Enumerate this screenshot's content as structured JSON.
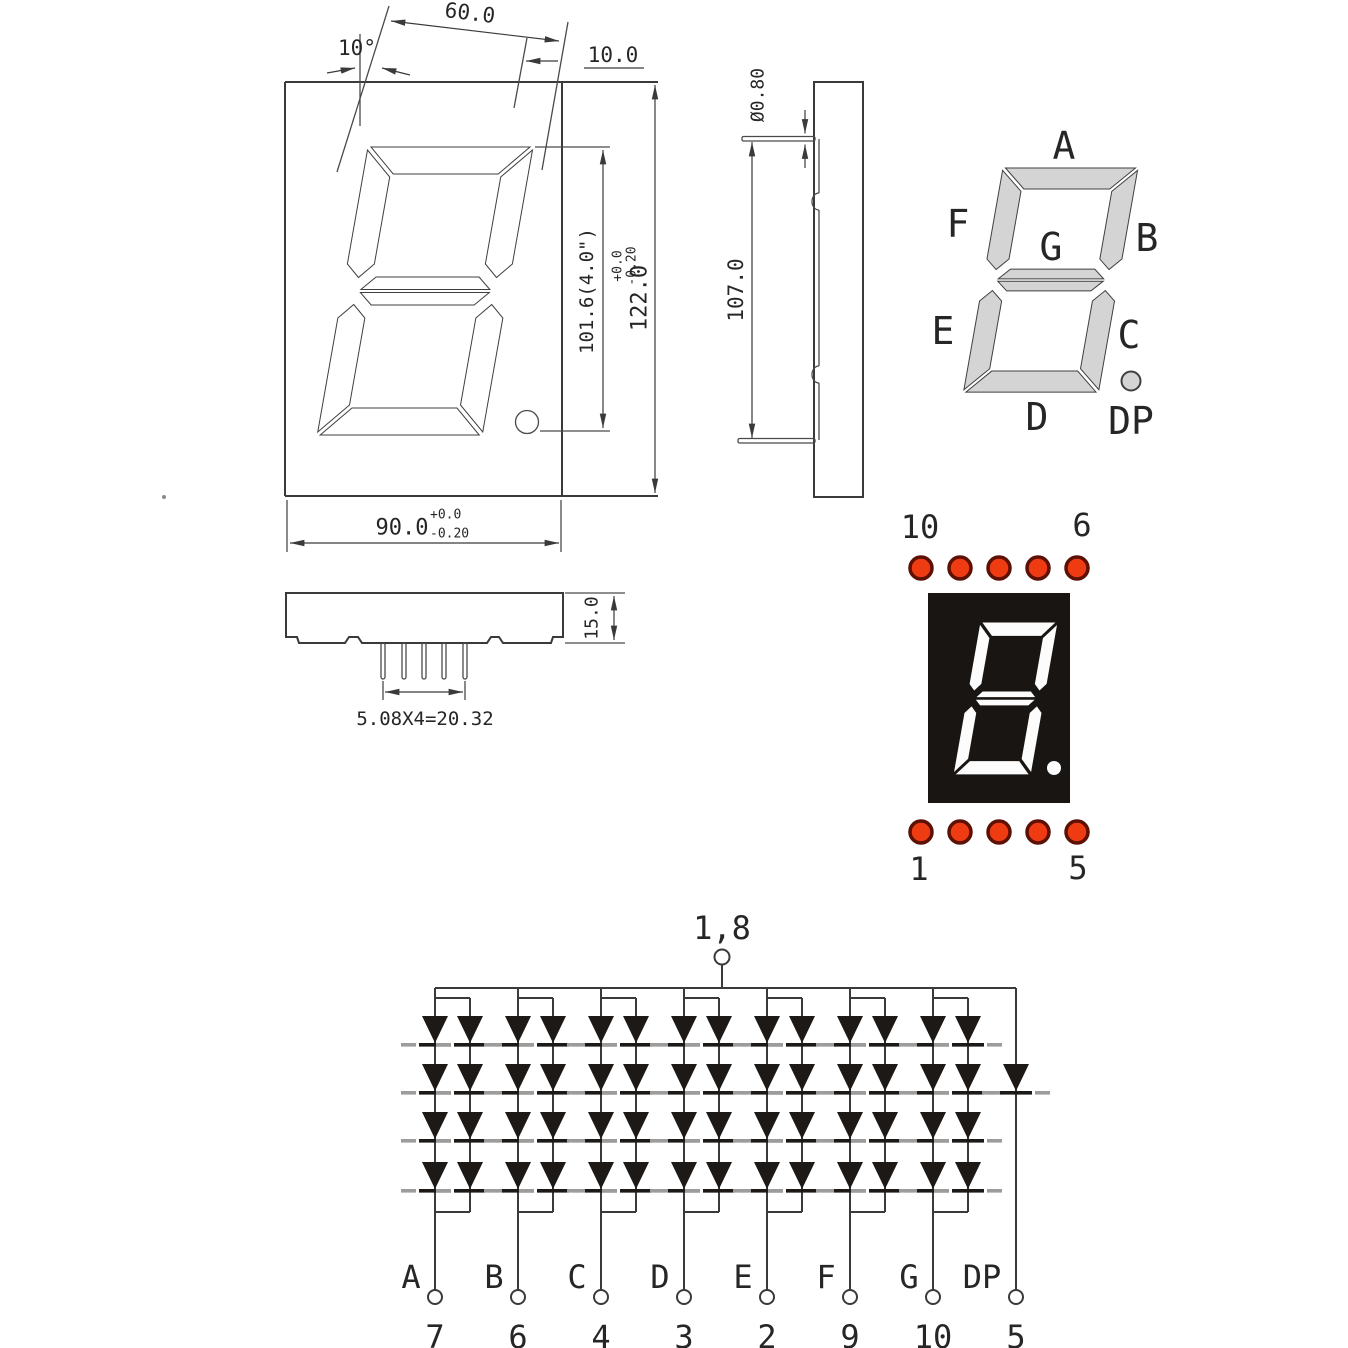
{
  "front_view": {
    "width_top": "60.0",
    "angle": "10°",
    "offset_top": "10.0",
    "digit_height": "101.6(4.0\")",
    "body_height": "122.0",
    "body_height_tol_top": "+0.0",
    "body_height_tol_bottom": "-0.20",
    "body_width": "90.0",
    "body_width_tol_top": "+0.0",
    "body_width_tol_bottom": "-0.20"
  },
  "side_view": {
    "pin_diameter": "Ø0.80",
    "pin_span": "107.0"
  },
  "bottom_view": {
    "height": "15.0",
    "pin_pitch": "5.08X4=20.32"
  },
  "segment_map": {
    "a": "A",
    "b": "B",
    "c": "C",
    "d": "D",
    "e": "E",
    "f": "F",
    "g": "G",
    "dp": "DP"
  },
  "display": {
    "top_left_pin": "10",
    "top_right_pin": "6",
    "bottom_left_pin": "1",
    "bottom_right_pin": "5"
  },
  "circuit": {
    "common_pins": "1,8",
    "segments": [
      {
        "name": "A",
        "pin": "7"
      },
      {
        "name": "B",
        "pin": "6"
      },
      {
        "name": "C",
        "pin": "4"
      },
      {
        "name": "D",
        "pin": "3"
      },
      {
        "name": "E",
        "pin": "2"
      },
      {
        "name": "F",
        "pin": "9"
      },
      {
        "name": "G",
        "pin": "10"
      },
      {
        "name": "DP",
        "pin": "5"
      }
    ]
  },
  "colors": {
    "led_dot": "#ee3b12",
    "led_dot_ring": "#5c1104",
    "segment_fill": "#d4d4d4",
    "display_body": "#191512",
    "digit_on": "#fcfcfc",
    "line": "#3a3a3a"
  }
}
